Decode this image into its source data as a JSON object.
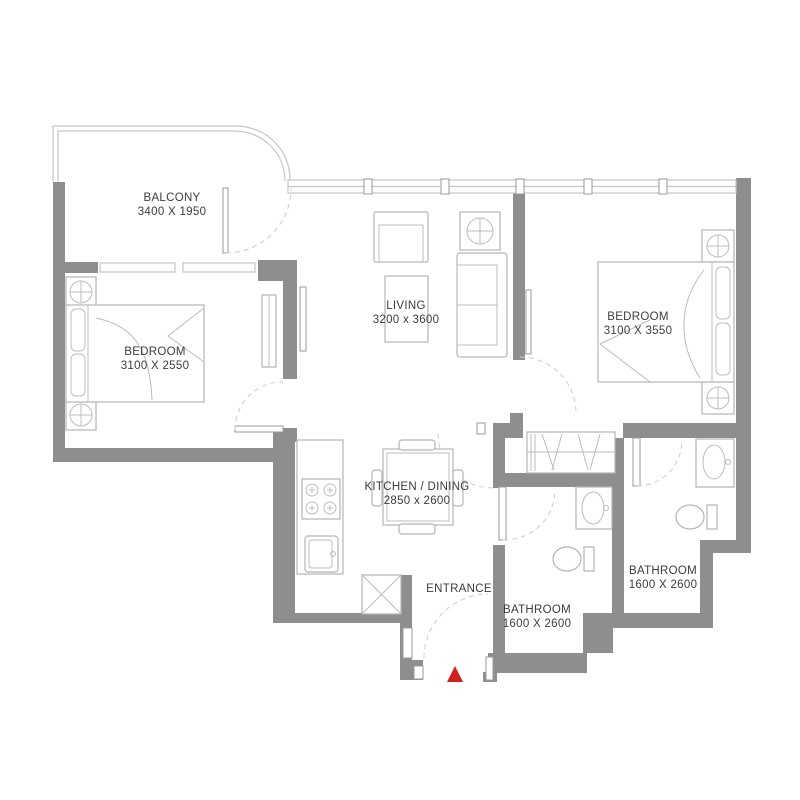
{
  "plan": {
    "rooms": {
      "balcony": {
        "label": "BALCONY",
        "dimensions": "3400 X 1950"
      },
      "bedroom_left": {
        "label": "BEDROOM",
        "dimensions": "3100 X 2550"
      },
      "living": {
        "label": "LIVING",
        "dimensions": "3200 x 3600"
      },
      "bedroom_right": {
        "label": "BEDROOM",
        "dimensions": "3100 X 3550"
      },
      "kitchen_dining": {
        "label": "KITCHEN / DINING",
        "dimensions": "2850 x 2600"
      },
      "entrance": {
        "label": "ENTRANCE"
      },
      "bathroom_left": {
        "label": "BATHROOM",
        "dimensions": "1600 X 2600"
      },
      "bathroom_right": {
        "label": "BATHROOM",
        "dimensions": "1600 X 2600"
      }
    },
    "marker": {
      "name": "entrance-marker",
      "shape": "triangle",
      "color": "#cf1f1f"
    },
    "colors": {
      "wall": "#8e8e8e",
      "furniture_line": "#b5b5b5",
      "window_line": "#c6c6c6",
      "door_swing_line": "#cccccc",
      "text": "#3c3c3c",
      "background": "#ffffff"
    }
  }
}
